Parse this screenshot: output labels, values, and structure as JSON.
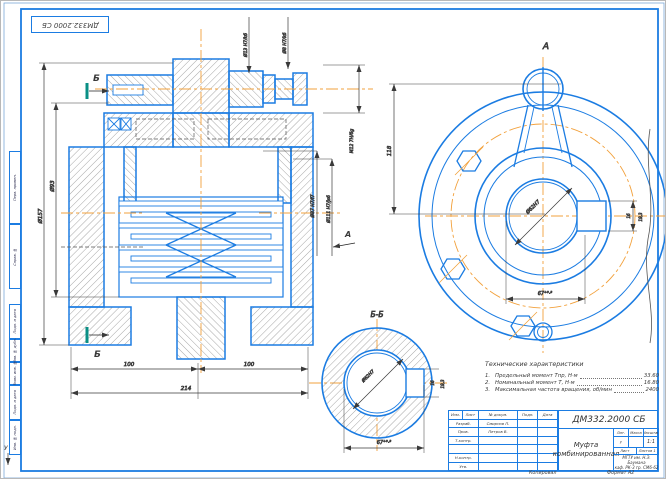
{
  "frame": {
    "stamp_doc_number": "ДМ332.2000 СБ",
    "fold_mark": "У",
    "side_labels": [
      "Перв. примен.",
      "Справ. №",
      "Подп. и дата",
      "Инв. № дубл.",
      "Взам. инв. №",
      "Подп. и дата",
      "Инв. № подл."
    ]
  },
  "main_view": {
    "section_letter": "Б",
    "view_letter": "А",
    "dims": {
      "d157": "Ø157",
      "d93": "Ø93",
      "d100a": "100",
      "d100b": "100",
      "d214": "214",
      "d87": "Ø87 H7/f7",
      "d111": "Ø111 H7/js6",
      "d13": "Ø13 H7/k6",
      "d8": "Ø8 H7/k6",
      "m12": "М12 7H/6g"
    }
  },
  "a_view": {
    "label": "А",
    "d118": "118",
    "bore": "Ø62H7",
    "keyway": "67⁺⁰·³",
    "k16": "16",
    "k19": "19,3"
  },
  "b_view": {
    "label": "Б-Б",
    "bore": "Ø62H7",
    "keyway": "67⁺⁰·³",
    "k16": "16",
    "k19": "19,3"
  },
  "tech": {
    "header": "Технические характеристики",
    "items": [
      {
        "num": "1.",
        "text": "Предельный момент Тпр, Н·м",
        "value": "33.60"
      },
      {
        "num": "2.",
        "text": "Номинальный момент Т, Н·м",
        "value": "16.80"
      },
      {
        "num": "3.",
        "text": "Максимальная частота вращения, об/мин",
        "value": "2400"
      }
    ]
  },
  "title_block": {
    "doc_number": "ДМ332.2000 СБ",
    "title_line1": "Муфта",
    "title_line2": "комбинированная",
    "headers": {
      "izm": "Изм.",
      "list": "Лист",
      "doc": "№ докум.",
      "podp": "Подп.",
      "data": "Дата"
    },
    "rows": [
      {
        "role": "Разраб.",
        "name": "Смирнов П."
      },
      {
        "role": "Пров.",
        "name": "Петров В."
      },
      {
        "role": "Т.контр.",
        "name": ""
      },
      {
        "role": "",
        "name": ""
      },
      {
        "role": "Н.контр.",
        "name": ""
      },
      {
        "role": "Утв.",
        "name": ""
      }
    ],
    "lit_header": "Лит.",
    "mass_header": "Масса",
    "scale_header": "Масштаб",
    "lit": "у",
    "scale": "1:1",
    "sheet_label": "Лист",
    "sheets_label": "Листов",
    "sheets": "1",
    "org_line1": "МГТУ им. Н.Э. Баумана",
    "org_line2": "каф. РК-3  гр. СМ6-62",
    "copied": "Копировал",
    "format": "Формат А2"
  },
  "colors": {
    "line_blue": "#1b7ce2",
    "centerline_orange": "#f2a13c",
    "dim_dark": "#3a3a3a",
    "section_teal": "#0a8f85",
    "letter_violet": "#5050d8"
  }
}
